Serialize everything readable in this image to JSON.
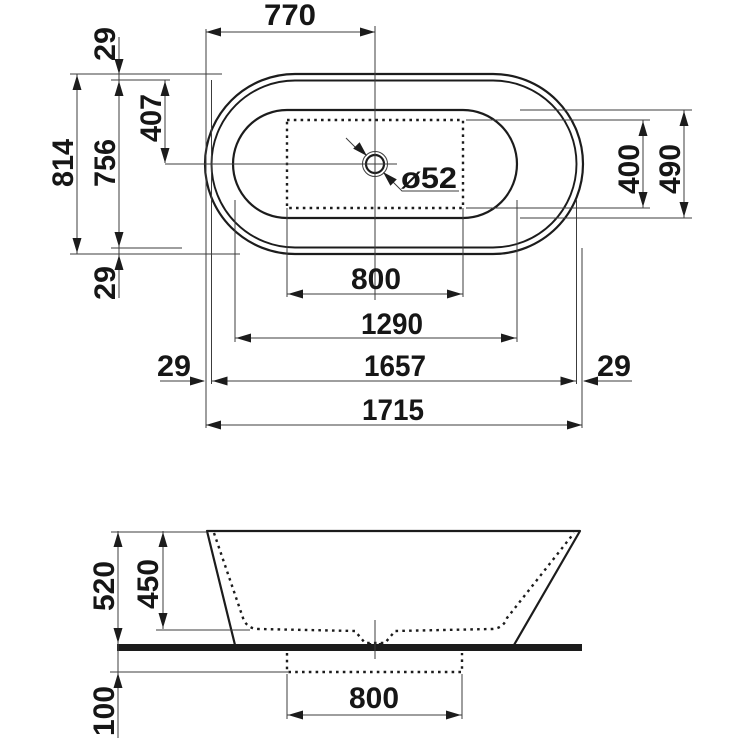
{
  "drawing_title": "Bathtub dimensional drawing",
  "top_view": {
    "d770": "770",
    "d29_top": "29",
    "d814": "814",
    "d756": "756",
    "d407": "407",
    "d29_bottom": "29",
    "drain_diameter": "ø52",
    "d400": "400",
    "d490": "490",
    "d800": "800",
    "d1290": "1290",
    "d29_left": "29",
    "d1657": "1657",
    "d29_right": "29",
    "d1715": "1715"
  },
  "side_view": {
    "d520": "520",
    "d450": "450",
    "d100": "100",
    "d800": "800"
  }
}
